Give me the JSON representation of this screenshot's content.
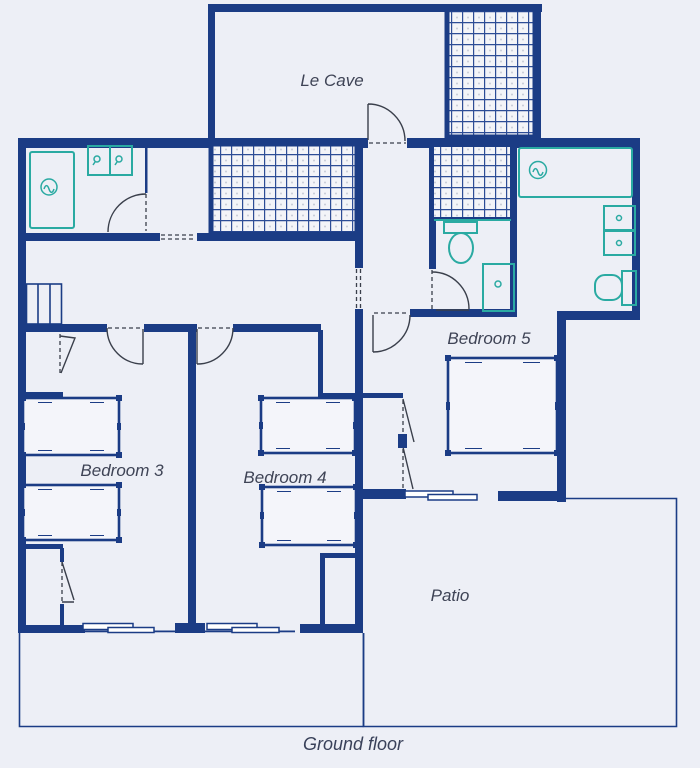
{
  "figure": {
    "caption": "Ground floor",
    "rooms": {
      "le_cave": "Le Cave",
      "bedroom3": "Bedroom 3",
      "bedroom4": "Bedroom 4",
      "bedroom5": "Bedroom 5",
      "patio": "Patio"
    }
  },
  "colors": {
    "wall": "#1b3c85",
    "fixture": "#2aaaa2",
    "label": "#3f4456",
    "background": "#edeff6",
    "hatch_line": "#2d4d96",
    "hatch_bg": "#f3f4f8",
    "door": "#3a3f4b",
    "window_fill": "#ffffff",
    "caption_color": "#39415a"
  },
  "icons": {
    "bathtub": "rounded-rect-outline-with-faucet-circle",
    "faucet": "circle-with-wave",
    "double_sink": "two-squares-with-drain-drops",
    "toilet": "tank-rect-and-bowl-ellipse",
    "shower_cabinet": "square-with-knob",
    "vanity_drawers": "stacked-squares-with-knobs",
    "stairs": "striped-rect",
    "tiled_floor": "grid-hatch",
    "door_swing": "quarter-arc-with-leaf",
    "folding_door": "dashed-line-with-diagonal-leaves",
    "window": "offset-double-rect"
  }
}
